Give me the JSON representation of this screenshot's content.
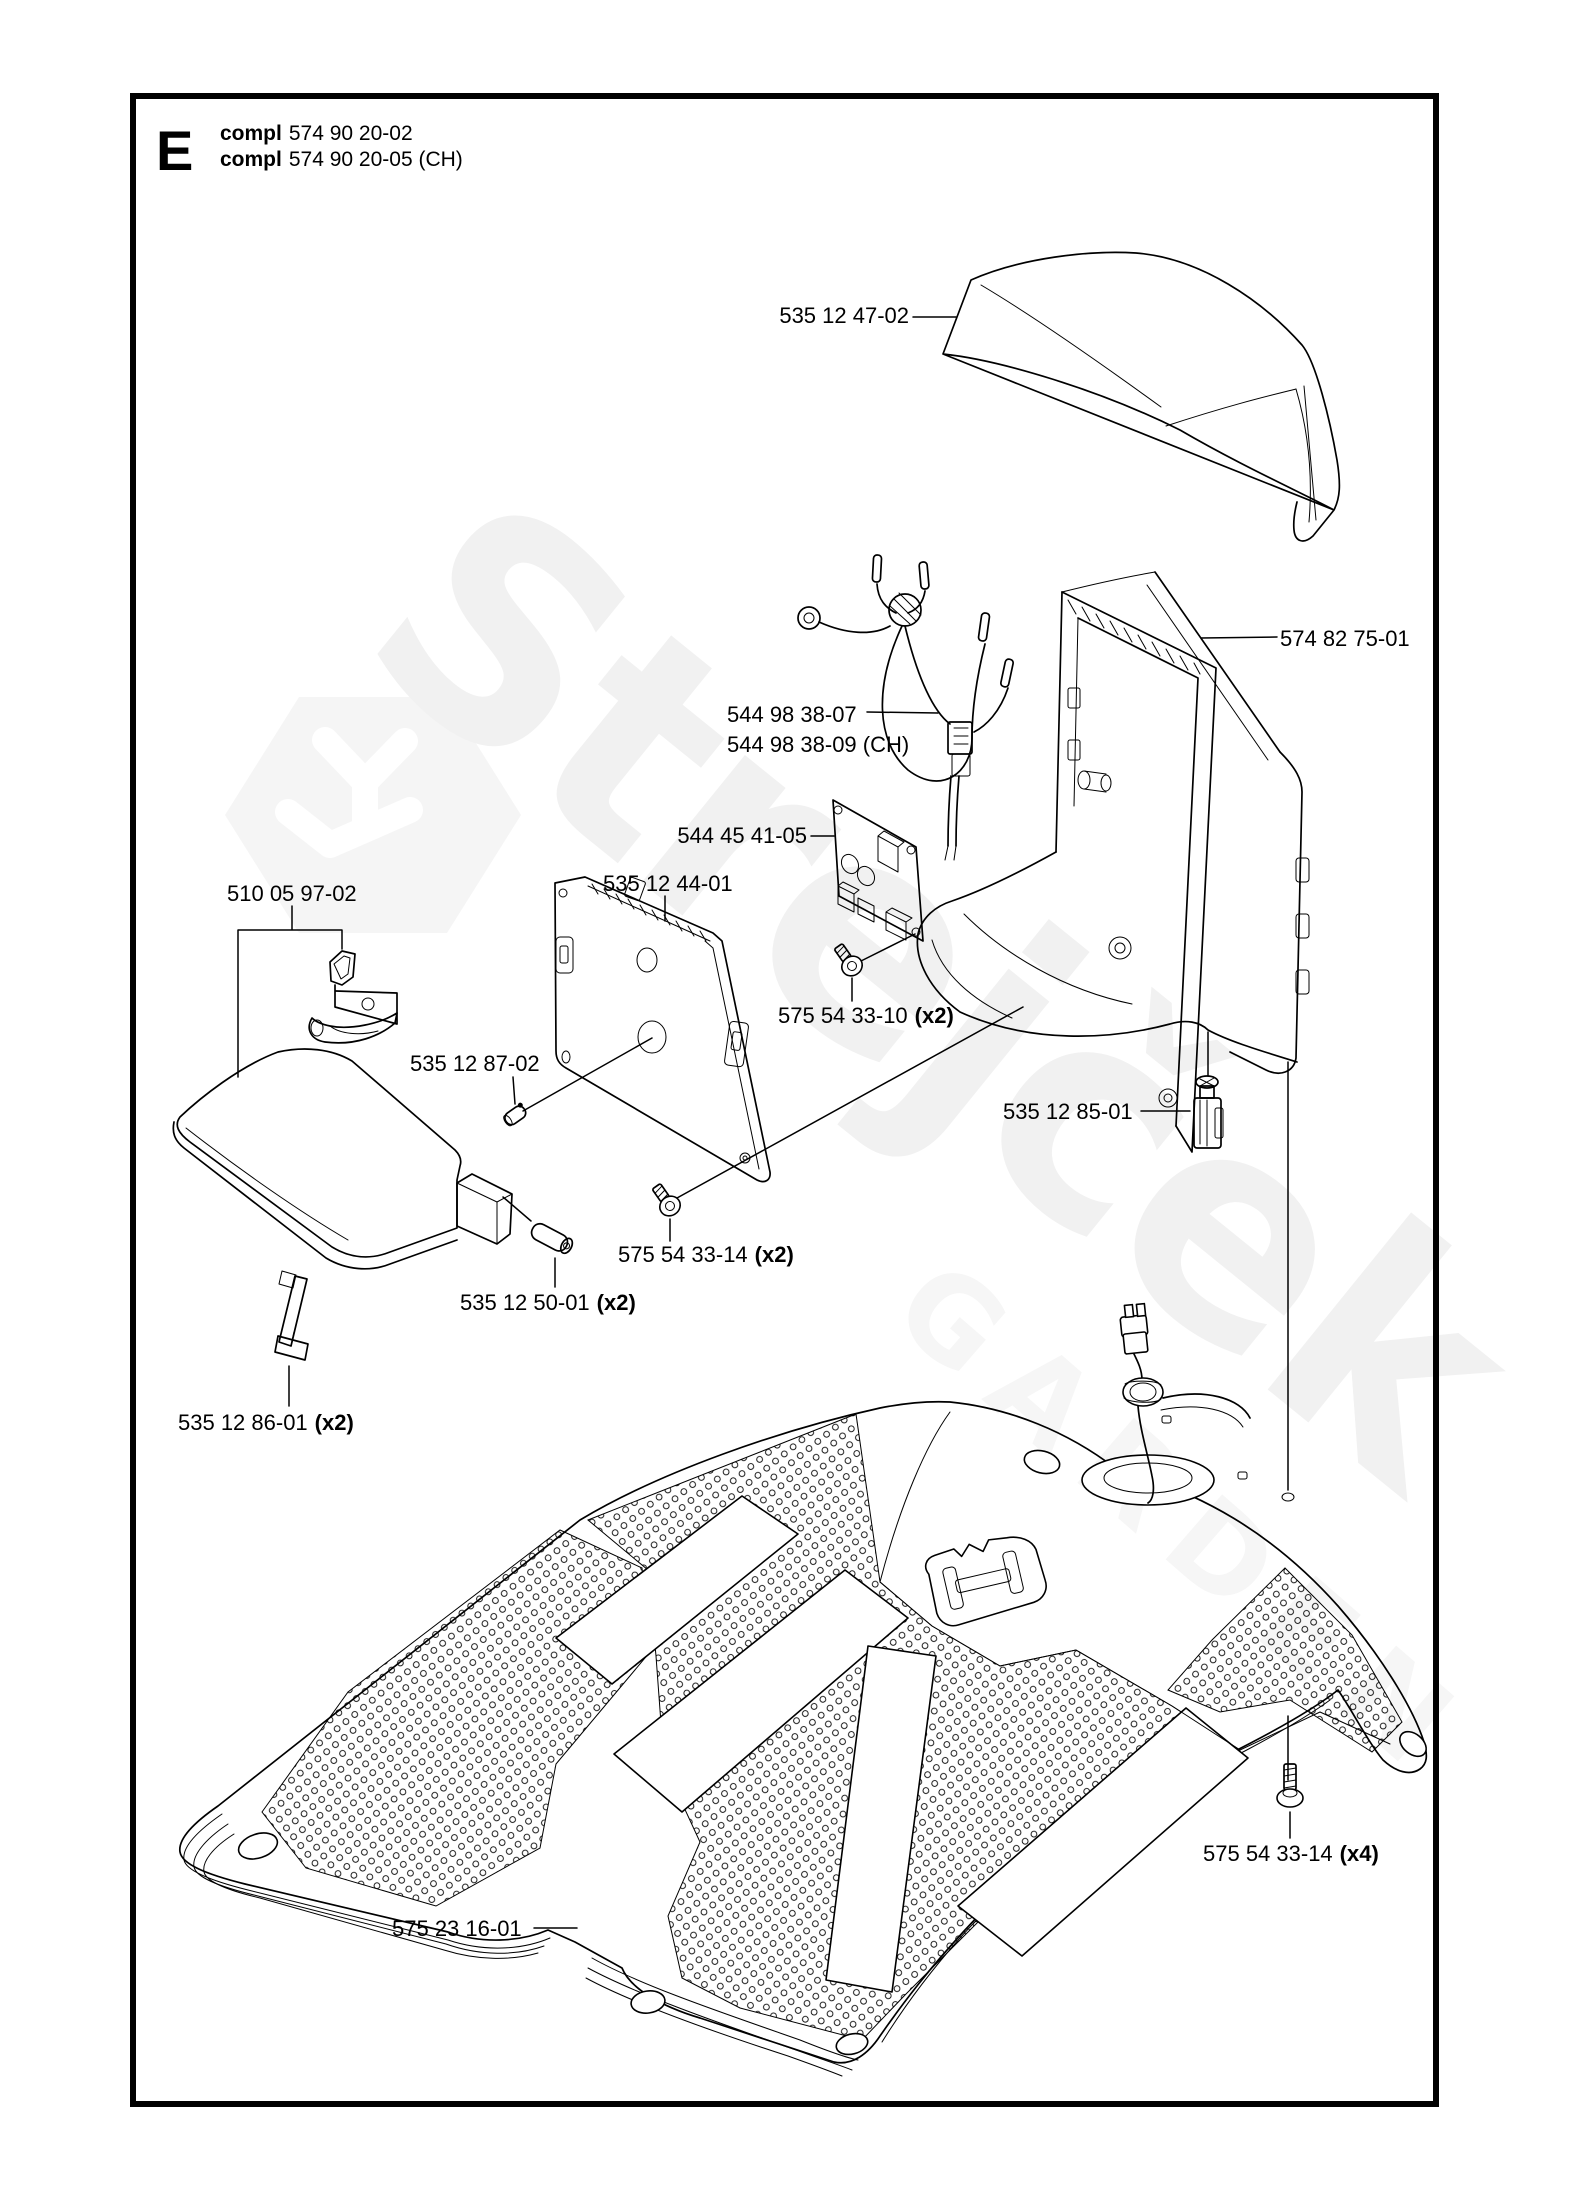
{
  "page": {
    "section_letter": "E"
  },
  "header": {
    "lines": [
      {
        "bold": "compl",
        "rest": "574 90 20-02"
      },
      {
        "bold": "compl",
        "rest": "574 90 20-05 (CH)"
      }
    ]
  },
  "watermark": {
    "brand": "Strejček",
    "sub": "GARDEN"
  },
  "parts": [
    {
      "id": "top-cover",
      "label": "535 12 47-02",
      "qty": ""
    },
    {
      "id": "rear-frame-body",
      "label": "574 82 75-01",
      "qty": ""
    },
    {
      "id": "wiring-harness",
      "label": "544 98 38-07",
      "qty": ""
    },
    {
      "id": "wiring-harness-ch",
      "label": "544 98 38-09 (CH)",
      "qty": ""
    },
    {
      "id": "circuit-board",
      "label": "544 45 41-05",
      "qty": ""
    },
    {
      "id": "mounting-panel",
      "label": "535 12 44-01",
      "qty": ""
    },
    {
      "id": "lid-handle",
      "label": "510 05 97-02",
      "qty": ""
    },
    {
      "id": "screw-8702",
      "label": "535 12 87-02",
      "qty": ""
    },
    {
      "id": "screw-3310",
      "label": "575 54 33-10",
      "qty": "(x2)"
    },
    {
      "id": "connector",
      "label": "535 12 85-01",
      "qty": ""
    },
    {
      "id": "screw-3314-2",
      "label": "575 54 33-14",
      "qty": "(x2)"
    },
    {
      "id": "pin",
      "label": "535 12 50-01",
      "qty": "(x2)"
    },
    {
      "id": "strap",
      "label": "535 12 86-01",
      "qty": "(x2)"
    },
    {
      "id": "screw-3314-4",
      "label": "575 54 33-14",
      "qty": "(x4)"
    },
    {
      "id": "chassis-body",
      "label": "575 23 16-01",
      "qty": ""
    }
  ]
}
